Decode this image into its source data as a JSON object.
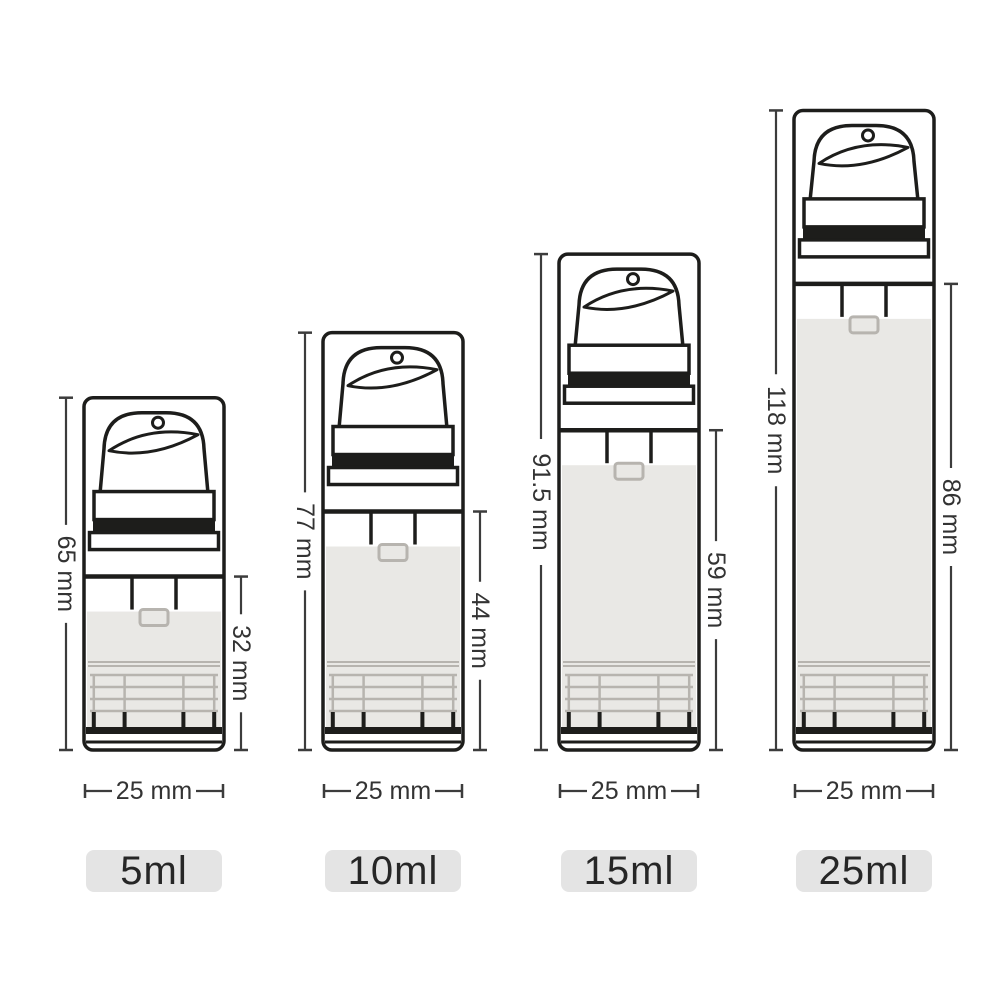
{
  "diagram_title": "airless-pump-bottle-size-chart",
  "colors": {
    "background": "#ffffff",
    "line": "#1d1d1b",
    "dim_line": "#3c3c3c",
    "label_text": "#333333",
    "fill_gray": "#e9e8e5",
    "grid_gray": "#b7b4af",
    "badge_bg": "#e4e4e4",
    "badge_text": "#262626"
  },
  "unit": "mm",
  "bottles": [
    {
      "id": "5ml",
      "size_label": "5ml",
      "total_height_mm": 65,
      "total_height_label": "65 mm",
      "body_height_mm": 32,
      "body_height_label": "32 mm",
      "width_mm": 25,
      "width_label": "25 mm"
    },
    {
      "id": "10ml",
      "size_label": "10ml",
      "total_height_mm": 77,
      "total_height_label": "77 mm",
      "body_height_mm": 44,
      "body_height_label": "44 mm",
      "width_mm": 25,
      "width_label": "25 mm"
    },
    {
      "id": "15ml",
      "size_label": "15ml",
      "total_height_mm": 91.5,
      "total_height_label": "91.5 mm",
      "body_height_mm": 59,
      "body_height_label": "59 mm",
      "width_mm": 25,
      "width_label": "25 mm"
    },
    {
      "id": "25ml",
      "size_label": "25ml",
      "total_height_mm": 118,
      "total_height_label": "118 mm",
      "body_height_mm": 86,
      "body_height_label": "86 mm",
      "width_mm": 25,
      "width_label": "25 mm"
    }
  ]
}
